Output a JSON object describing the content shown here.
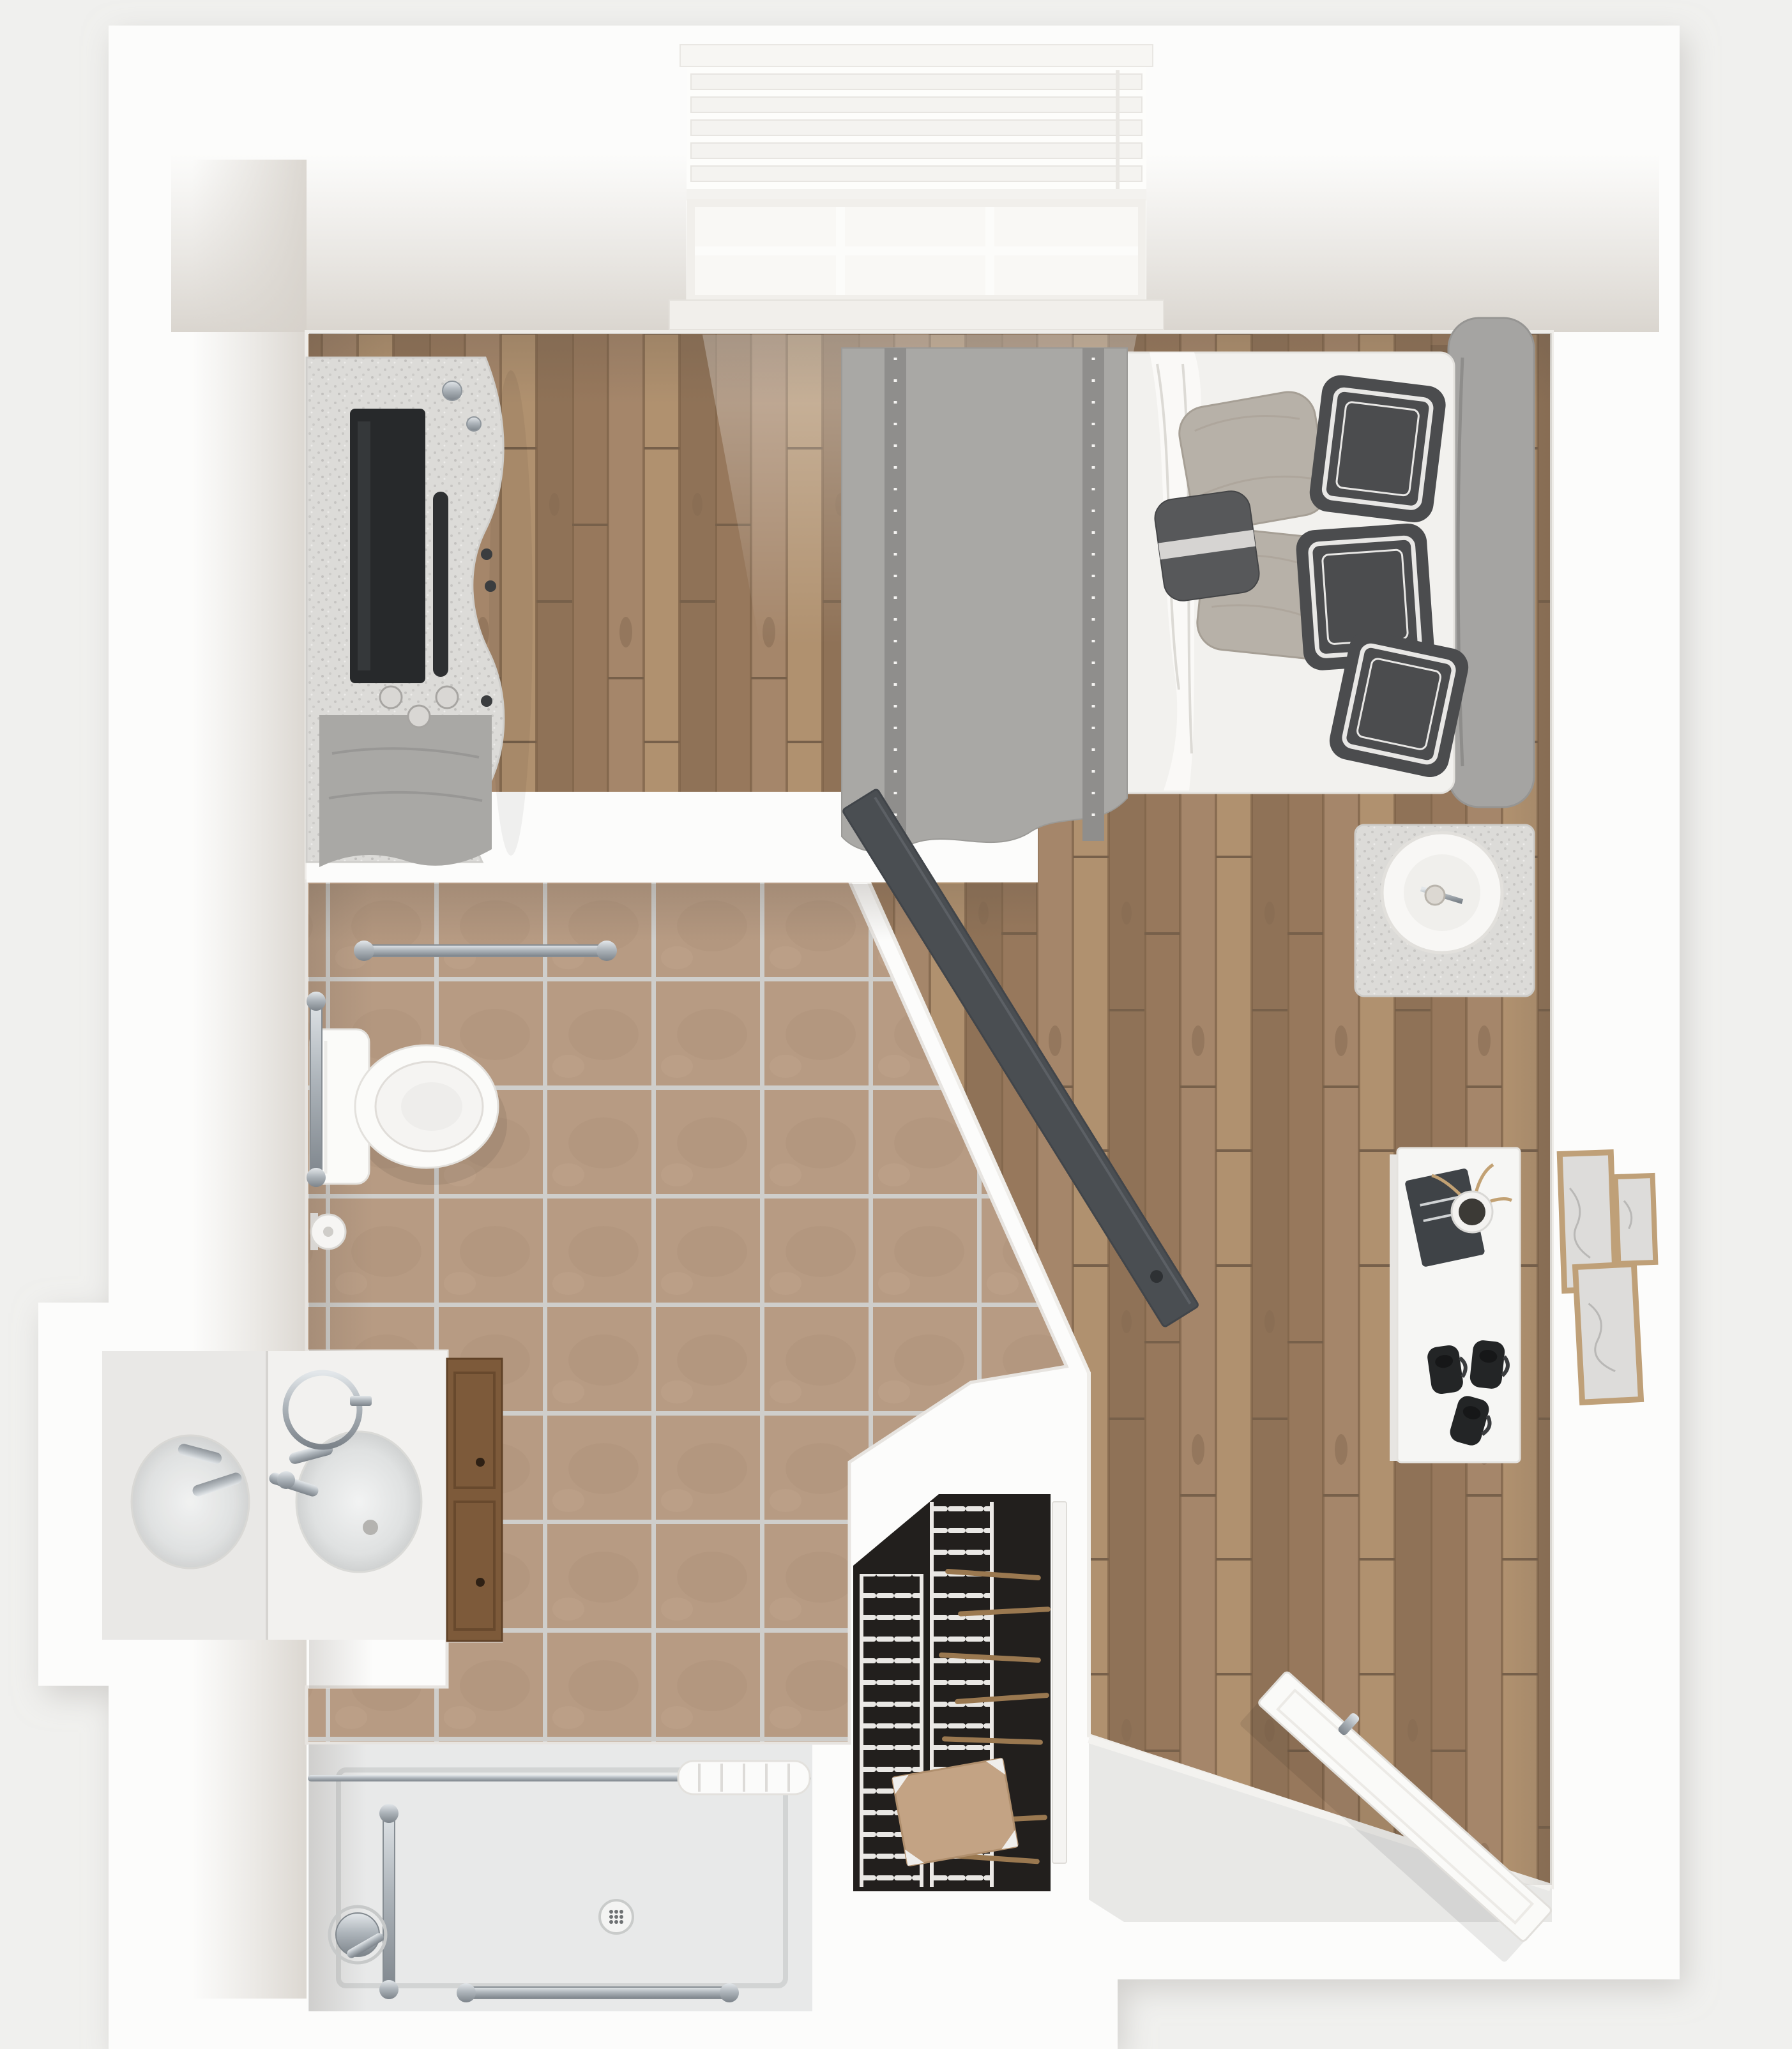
{
  "palette": {
    "background": "#f0f0ee",
    "wall": "#fcfcfb",
    "wall_face": "#d9d5cf",
    "wood_floor": "#a5866a",
    "tile_floor": "#b79b83",
    "tile_grout": "#cfcecb",
    "shower_pan": "#e8e9e9",
    "entry_floor": "#e8e8e6",
    "closet_dark": "#221f1d",
    "wire_shelf": "#e9e7e4",
    "hanger_wood": "#9a7850",
    "cardboard": "#c3a384",
    "cabinet_wood": "#7d5a3a",
    "door_slab": "#4a4e52",
    "entry_door": "#fafaf8",
    "mattress": "#f2f1ee",
    "sheet": "#faf9f7",
    "blanket": "#a9a8a5",
    "blanket_band": "#8f8e8c",
    "headboard": "#a5a4a2",
    "pillow_dark": "#4b4c4e",
    "pillow_trim": "#e8e7e5",
    "pillow_light": "#b7b1a8",
    "furniture_gray": "#dcdbd8",
    "tv_black": "#27292b",
    "porcelain": "#fbfbf9",
    "frame_wood": "#bfa078",
    "art_paper": "#dddcda",
    "book_dark": "#3f4347",
    "decor_black": "#232526",
    "window_glow": "#fdfdfb"
  },
  "scene": {
    "type": "3d-top-down-floor-plan-render",
    "rooms": [
      {
        "name": "bedroom",
        "floor": "wood-plank"
      },
      {
        "name": "bathroom",
        "floor": "beige-tile"
      },
      {
        "name": "roll-in-shower",
        "floor": "shower-pan"
      },
      {
        "name": "closet",
        "floor": "dark-with-wire-shelving"
      },
      {
        "name": "entry-vestibule",
        "floor": "light-gray"
      }
    ],
    "furniture": [
      "window-with-blinds",
      "dresser-with-tv",
      "soundbar",
      "gray-throw",
      "bed",
      "headboard",
      "gray-blanket",
      "white-sheet",
      "light-pillows",
      "dark-trimmed-pillows",
      "lumbar-pillow",
      "nightstand",
      "drum-shade-lamp",
      "console-table",
      "book",
      "potted-plant",
      "black-decor-set",
      "gallery-frame-large",
      "gallery-frame-small",
      "gallery-frame-tall",
      "toilet",
      "grab-bar-top",
      "grab-bar-left",
      "toilet-paper-holder",
      "vanity-counter",
      "vanity-mirror-reflection",
      "sink-basin",
      "faucet",
      "towel-ring",
      "sink-cabinet",
      "curtain-rod",
      "shower-curtain",
      "shower-valve",
      "shower-drain",
      "shower-grab-bar-vertical",
      "shower-grab-bar-bottom",
      "wire-shelf-column-a",
      "wire-shelf-column-b",
      "clothes-hangers",
      "storage-box",
      "closet-door-panel",
      "sliding-barn-door",
      "entry-door-open"
    ]
  }
}
